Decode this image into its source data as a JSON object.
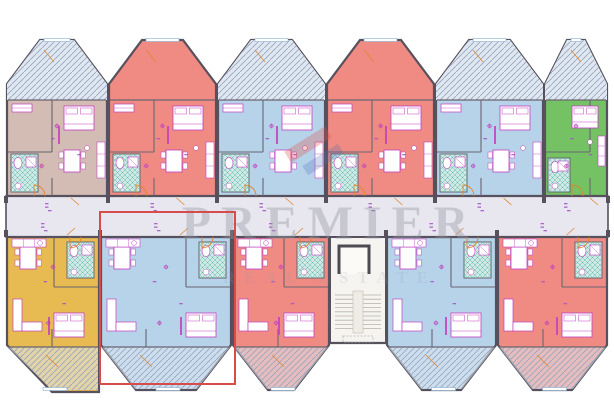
{
  "watermark": {
    "text": "PREMIER",
    "subtext": "REAL ESTATE",
    "text_color": "rgba(150,152,166,0.40)",
    "subtext_color": "rgba(150,152,166,0.16)",
    "logo_red": "rgba(224,80,70,0.30)",
    "logo_blue": "rgba(80,110,180,0.26)"
  },
  "highlight": {
    "x": 99,
    "y": 211,
    "width": 133,
    "height": 170,
    "color": "#d84b4b"
  },
  "palette": {
    "background": "#ffffff",
    "wall": "#56515c",
    "inner_wall": "#6a6570",
    "corridor": "#e8e7ef",
    "furniture": "#c240c0",
    "label_purple": "#a557c8",
    "door_orange": "#e0862c",
    "bath_fill": "#cfe9e4",
    "bath_line": "#63b8ae",
    "balcony_fill": "#dfe7f0",
    "hatch_line": "#96a4bd",
    "window_line": "#85aed2",
    "stair_fill": "#f5f4f1",
    "stair_tread": "#b9b2a8"
  },
  "layout": {
    "corridor": {
      "x": 6,
      "y": 196,
      "width": 602,
      "height": 41
    },
    "stairwell": {
      "x": 330,
      "y": 237,
      "width": 56,
      "height": 106
    },
    "top_units": [
      {
        "name": "top-1",
        "color": "#d3bcb3",
        "x": 6,
        "width": 102,
        "balcony_hatched": true
      },
      {
        "name": "top-2",
        "color": "#ef8b82",
        "x": 108,
        "width": 109,
        "balcony_hatched": false
      },
      {
        "name": "top-3",
        "color": "#b6d3ea",
        "x": 217,
        "width": 109,
        "balcony_hatched": true
      },
      {
        "name": "top-4",
        "color": "#ef8b82",
        "x": 326,
        "width": 109,
        "balcony_hatched": false
      },
      {
        "name": "top-5",
        "color": "#b6d3ea",
        "x": 435,
        "width": 109,
        "balcony_hatched": true
      },
      {
        "name": "top-6",
        "color": "#74c263",
        "x": 544,
        "width": 64,
        "balcony_hatched": true
      }
    ],
    "bottom_units": [
      {
        "name": "bottom-1",
        "color": "#e7ba52",
        "x": 6,
        "width": 94,
        "flat_right": true
      },
      {
        "name": "bottom-2",
        "color": "#b6d3ea",
        "x": 100,
        "width": 132,
        "highlighted": true
      },
      {
        "name": "bottom-3",
        "color": "#ef8b82",
        "x": 232,
        "width": 98
      },
      {
        "name": "bottom-4",
        "color": "#b6d3ea",
        "x": 386,
        "width": 111
      },
      {
        "name": "bottom-5",
        "color": "#ef8b82",
        "x": 497,
        "width": 111
      }
    ]
  }
}
